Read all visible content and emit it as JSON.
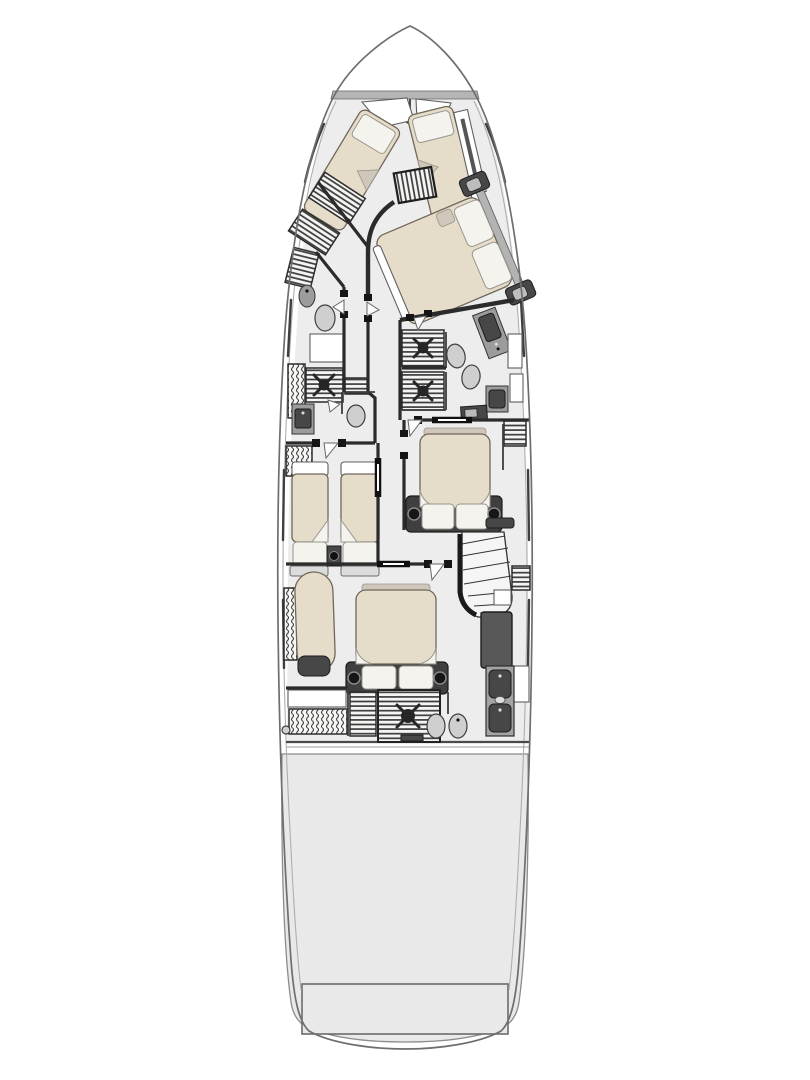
{
  "colors": {
    "background": "#ffffff",
    "hull_line": "#6e6e6e",
    "wall": "#2b2b2b",
    "floor": "#ededed",
    "engine_floor": "#e9e9e9",
    "deck_band": "#b5b5b5",
    "bed": "#e6dcca",
    "pillow": "#f5f3ee",
    "fold": "#cfc8ba",
    "dark_furniture": "#474747",
    "bed_frame": "#3f3f3f",
    "mid_furniture": "#9c9c9c",
    "fixture": "#cfcfcf",
    "light_furniture": "#dcdcdc",
    "white_furniture": "#ffffff",
    "hatch_line": "#3c3c3c"
  }
}
